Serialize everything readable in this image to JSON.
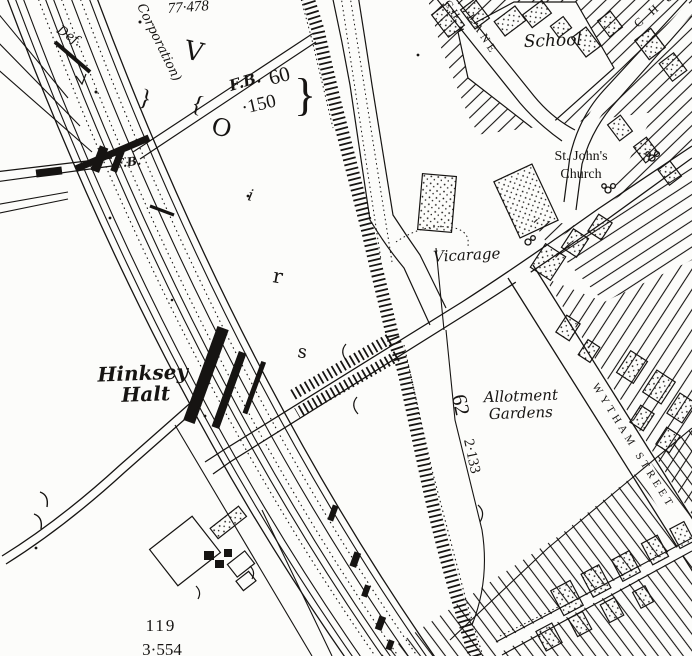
{
  "colors": {
    "ink": "#161412",
    "paper": "#fcfcfa"
  },
  "map": {
    "labels": {
      "benchmark_top": "77·478",
      "boundary_def": "Def.",
      "corporation": "Corporation)",
      "fb_small": "F.B.",
      "fb_bridge": "F.B.",
      "fb_bridge_num": "60",
      "fb_bridge_level": "·150",
      "brace_large": "}",
      "brace_left": "{",
      "brace_right": "}",
      "school": "School",
      "lane_fragment": "CH",
      "lane": "LANE",
      "church_street_fragment": "C H U",
      "st_johns_line1": "St. John's",
      "st_johns_line2": "Church",
      "vicarage": "Vicarage",
      "hinksey_line1": "Hinksey",
      "hinksey_line2": "Halt",
      "allotment_line1": "Allotment",
      "allotment_line2": "Gardens",
      "parcel_62": "62",
      "parcel_62_area": "2·133",
      "wytham_street": "WYTHAM STREET",
      "parcel_119": "119",
      "parcel_119_area": "3·554"
    },
    "reservoir_letters": {
      "l1": "V",
      "l2": "O",
      "l3": "i",
      "l4": "r",
      "l5": "s"
    }
  }
}
